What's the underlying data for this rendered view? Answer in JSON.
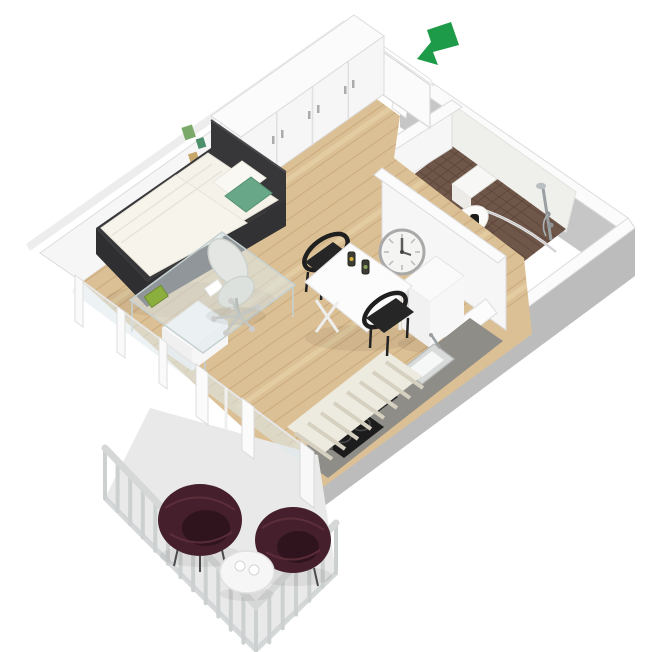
{
  "scene": {
    "description": "3D isometric floor plan rendering of a studio apartment with balcony, viewed from above",
    "view": "axonometric top-down",
    "background": "#ffffff"
  },
  "colors": {
    "background": "#ffffff",
    "wall_top": "#fbfbfb",
    "wall_face": "#f6f6f6",
    "wall_edge": "#dcdcdc",
    "wall_outer": "#c6c6c6",
    "wall_outer_dark": "#bcbcbc",
    "wood": "#dcc095",
    "plank": "#c9a97b",
    "plank_light": "#ead8ae",
    "tile_brown": "#6e5649",
    "grout": "#5a4237",
    "balcony_floor": "#e9e9e9",
    "railing": "#ccd0cf",
    "handrail": "#d6d8d7",
    "frame_dark": "#37373a",
    "mattress": "#f5f2ea",
    "pillow_green": "#68a787",
    "arrow_green": "#1e9b48",
    "chair_black": "#262626",
    "wicker": "#45202c",
    "wicker_light": "#63313f",
    "counter": "#8f8d87",
    "counter_front": "#454440",
    "appliance_black": "#1c1c1c",
    "glass": "#dfe9ec",
    "rug": "#edeadf",
    "rug_stripe": "#d6d0c0",
    "clock_ring": "#a9a9a9",
    "white_goods": "#fafafa",
    "steel": "#9aa0a2",
    "decor_green": "#7aa96a",
    "decor_teal": "#4d8f6b",
    "decor_tan": "#c8a76b",
    "desk_pad": "#8cae3c"
  },
  "entrance": {
    "indicator": "green-arrow",
    "direction": "pointing down-left toward open front door"
  },
  "rooms": {
    "entry_hall": {
      "floor": "light oak planks",
      "features": [
        "open-front-door",
        "closet"
      ]
    },
    "main_room": {
      "floor": "light oak planks",
      "furniture": [
        "wardrobe",
        "single-bed",
        "green-accent-pillow",
        "wall-decor",
        "glass-desk",
        "office-chair",
        "dining-table",
        "two-black-chairs",
        "wall-clock",
        "refrigerator",
        "striped-rug"
      ]
    },
    "bathroom": {
      "floor": "brown mosaic tile",
      "fixtures": [
        "toilet",
        "shower-set",
        "shower-rail",
        "washbasin",
        "trash-bin",
        "open-door"
      ]
    },
    "kitchen": {
      "features": [
        "gray-counter",
        "two-burner-cooktop",
        "sink-with-faucet",
        "coffee-machine",
        "canisters"
      ]
    },
    "balcony": {
      "floor": "concrete",
      "furniture": [
        "wicker-chair",
        "wicker-chair",
        "round-side-table",
        "two-cups"
      ],
      "features": [
        "baluster-railing"
      ]
    }
  }
}
